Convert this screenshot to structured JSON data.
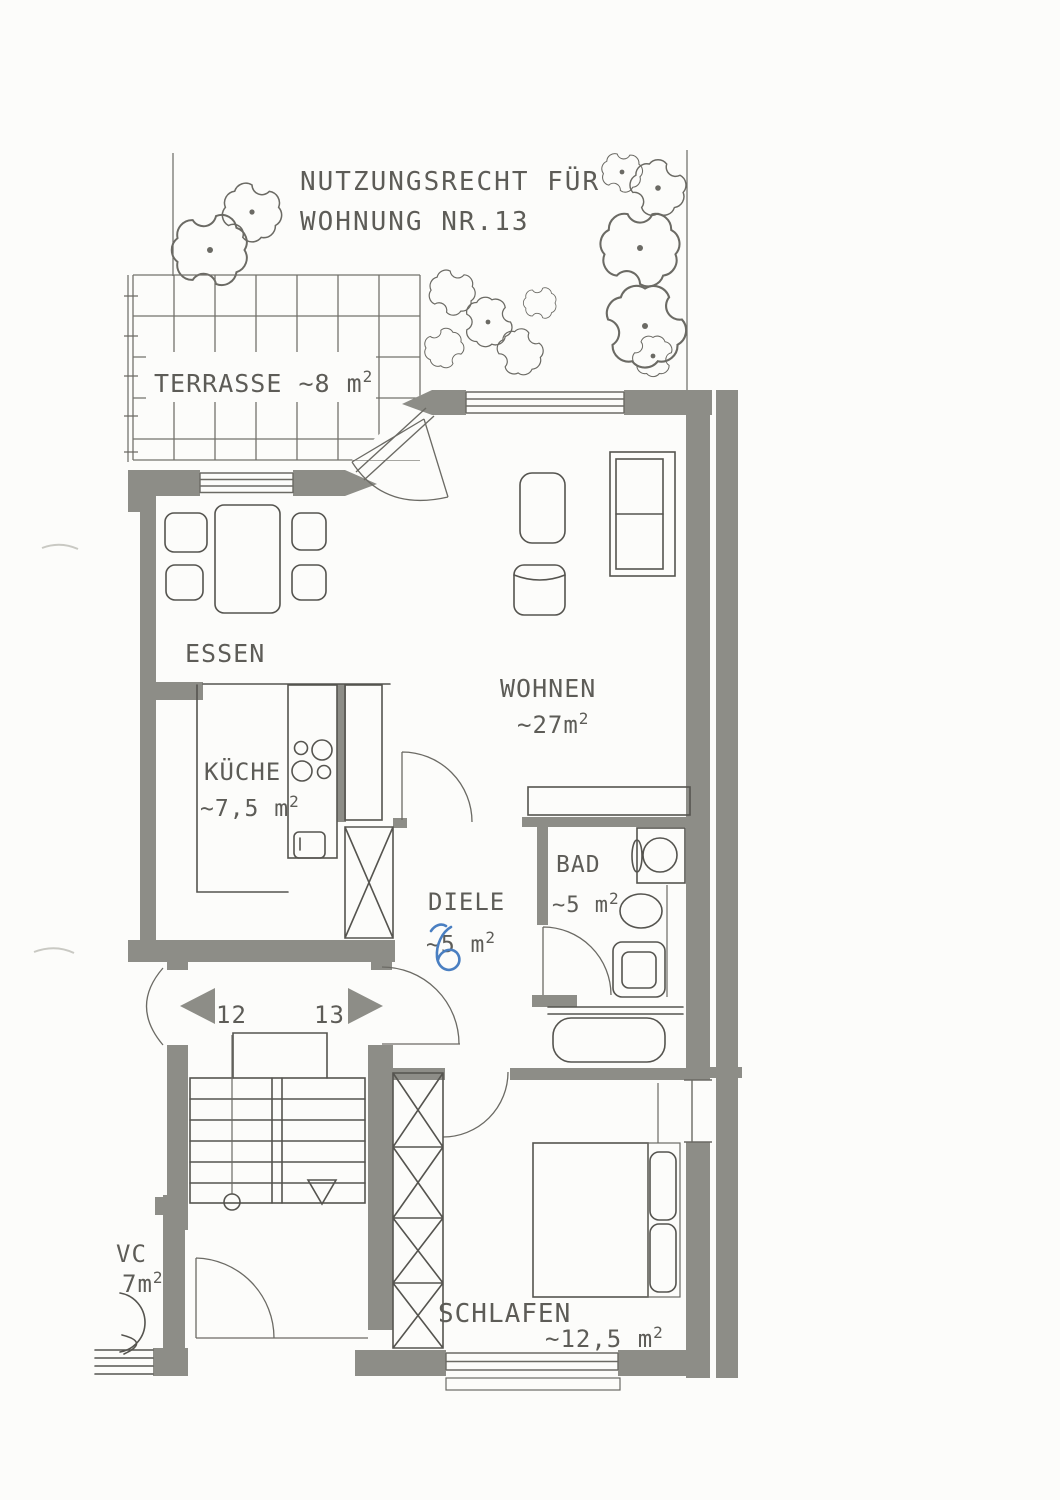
{
  "title": {
    "line1": "NUTZUNGSRECHT FÜR",
    "line2": "WOHNUNG NR.13"
  },
  "rooms": {
    "terrasse": {
      "label": "TERRASSE ~8 m",
      "sup": "2"
    },
    "essen": {
      "label": "ESSEN"
    },
    "wohnen": {
      "label": "WOHNEN",
      "area": "~27m",
      "sup": "2"
    },
    "kueche": {
      "label": "KÜCHE",
      "area": "~7,5 m",
      "sup": "2"
    },
    "diele": {
      "label": "DIELE",
      "area": "~5 m",
      "sup": "2",
      "handwritten_note": {
        "text": "6",
        "color": "#4a7fc1"
      }
    },
    "bad": {
      "label": "BAD",
      "area": "~5 m",
      "sup": "2"
    },
    "schlafen": {
      "label": "SCHLAFEN",
      "area": "~12,5 m",
      "sup": "2"
    },
    "wc": {
      "label": "VC",
      "area": "7m",
      "sup": "2"
    }
  },
  "apartments": {
    "left_number": "12",
    "right_number": "13"
  },
  "colors": {
    "wall": "#8d8d87",
    "line": "#55544f",
    "text": "#5d5c57",
    "annotation_blue": "#4a7fc1",
    "paper": "#fcfcfa"
  }
}
